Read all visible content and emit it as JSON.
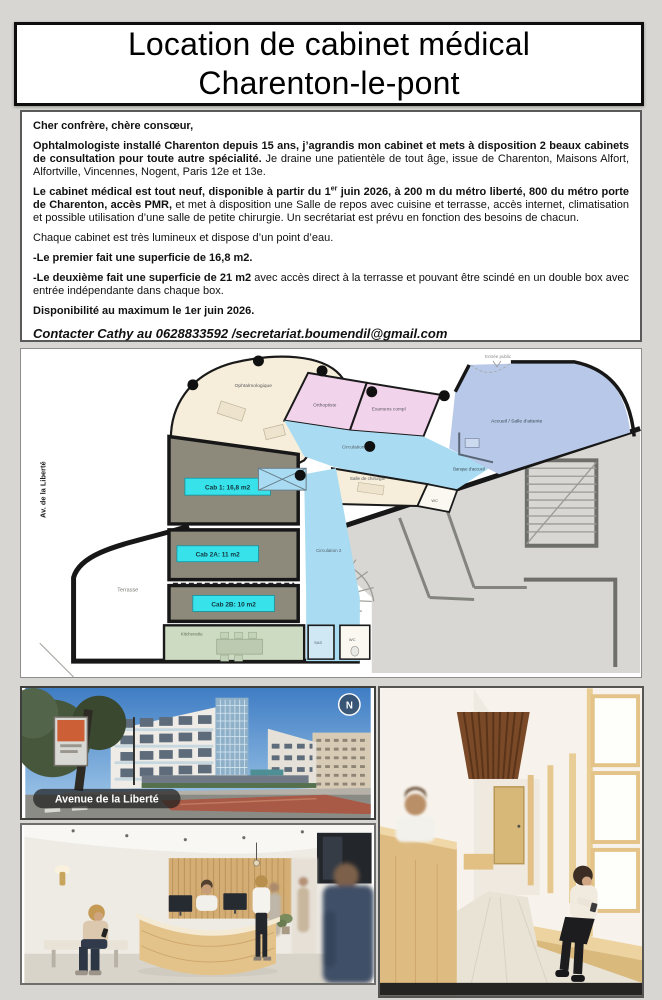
{
  "header": {
    "title_line1": "Location de cabinet médical",
    "title_line2": "Charenton-le-pont"
  },
  "letter": {
    "salutation": "Cher confrère, chère consœur,",
    "p1_bold": "Ophtalmologiste installé Charenton depuis 15 ans, j’agrandis mon cabinet et mets à disposition 2 beaux cabinets de consultation pour toute autre spécialité.",
    "p1_rest": " Je draine une patientèle de tout âge, issue de Charenton, Maisons Alfort, Alfortville, Vincennes, Nogent, Paris 12e et 13e.",
    "p2_bold_pre": "Le cabinet médical est tout neuf, disponible à partir du 1",
    "p2_sup": "er",
    "p2_bold_post": " juin 2026, à 200 m du métro liberté, 800 du métro porte de Charenton, accès PMR,",
    "p2_rest": " et met à disposition une Salle de repos avec cuisine et terrasse, accès internet, climatisation et possible utilisation d’une salle de petite chirurgie. Un secrétariat est prévu en fonction des besoins de chacun.",
    "p3": "Chaque cabinet est très lumineux et dispose d’un point d’eau.",
    "p4": "-Le premier fait une superficie de 16,8 m2.",
    "p5_bold": "-Le deuxième fait une superficie de 21 m2",
    "p5_rest": " avec accès direct à la terrasse et pouvant être scindé en un double box avec entrée indépendante dans chaque box.",
    "p6": "Disponibilité au maximum le 1er juin 2026.",
    "contact": "Contacter Cathy au 0628833592 /secretariat.boumendil@gmail.com"
  },
  "floorplan": {
    "street_label": "Av. de la Liberté",
    "entrance_label": "Entrée public",
    "interior_label": "Espace intérieur",
    "rooms": {
      "ophtalmologique": "Ophtalmologique",
      "orthoptiste": "Orthoptiste",
      "examens": "Examens compl",
      "circulation1": "Circulation 1",
      "accueil": "Accueil / Salle d'attente",
      "banque": "Banque d'accueil",
      "chirurgie": "Salle de chirurgie",
      "wc_haut": "WC",
      "cab1": "Cab 1: 16,8 m2",
      "cab2a": "Cab 2A: 11 m2",
      "cab2b": "Cab 2B: 10 m2",
      "circulation2": "Circulation 2",
      "sas": "SAS",
      "wc_bas": "WC",
      "kitchenette": "Kitchenette",
      "terrasse": "Terrasse"
    },
    "colors": {
      "cab_fill": "#8d897b",
      "label_cyan": "#38e2ea",
      "circulation_blue": "#a9dcf2",
      "accueil_blue": "#b7c8e8",
      "room_cream": "#f6eeda",
      "room_pink": "#f2d3ec",
      "kitchen_green": "#ccdbc1",
      "existing_gray": "#d8d7d3",
      "wall_black": "#171717"
    }
  },
  "photos": {
    "street": {
      "caption": "Avenue de la Liberté",
      "compass": "N"
    }
  }
}
